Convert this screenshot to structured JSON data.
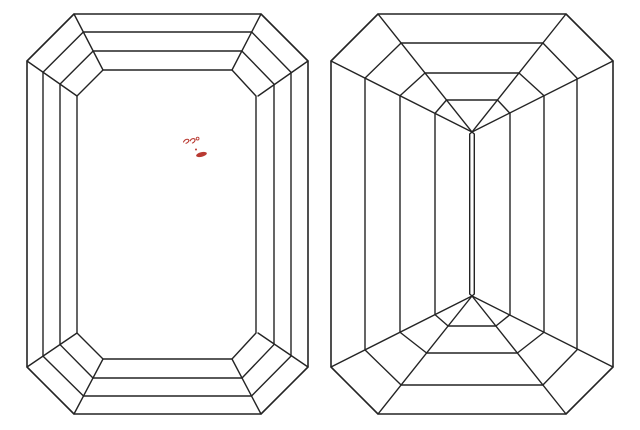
{
  "canvas": {
    "width": 640,
    "height": 430,
    "background": "#ffffff"
  },
  "style": {
    "line_color": "#242424",
    "line_width": 1.4,
    "girdle_line_width": 1.6,
    "annotation_color": "#b93a32"
  },
  "figures": {
    "crown": {
      "name": "emerald-cut-crown-top-view",
      "girdle": {
        "x1": 27,
        "y1": 14,
        "x2": 308,
        "y2": 414,
        "cut": 47
      },
      "table": {
        "x1": 77,
        "y1": 70,
        "x2": 256,
        "y2": 359,
        "cut": 26
      },
      "steps": [
        {
          "x1": 43,
          "y1": 32,
          "x2": 291,
          "y2": 396
        },
        {
          "x1": 60,
          "y1": 51,
          "x2": 274,
          "y2": 378
        }
      ]
    },
    "pavilion": {
      "name": "emerald-cut-pavilion-bottom-view",
      "girdle": {
        "x1": 331,
        "y1": 14,
        "x2": 613,
        "y2": 414,
        "cut": 47
      },
      "steps": [
        {
          "x1": 365,
          "y1": 43,
          "x2": 577,
          "y2": 385
        },
        {
          "x1": 400,
          "y1": 73,
          "x2": 544,
          "y2": 353
        },
        {
          "x1": 435,
          "y1": 100,
          "x2": 510,
          "y2": 326
        }
      ],
      "apex_top": {
        "x": 472,
        "y": 132
      },
      "apex_bottom": {
        "x": 472,
        "y": 296
      },
      "keel_half_gap": 2.3,
      "keel_inset": 2
    }
  },
  "annotation": {
    "name": "red-ink-scribble",
    "color": "#b93a32",
    "x": 183,
    "y": 136,
    "strokes": [
      "M0.5,6 C1.5,3.5 4.2,2.6 5.6,3.8 C6.4,4.9 4.8,6.9 3,7.3",
      "M7.2,4.8 C8,2.6 10.6,2 11.8,3.2 C12.6,4.6 11,6.6 9.4,7"
    ],
    "degree_circle": {
      "cx": 14.6,
      "cy": 2.6,
      "r": 1.4
    },
    "dot": {
      "cx": 13,
      "cy": 13.5,
      "r": 1
    },
    "ellipse": {
      "cx": 18.5,
      "cy": 18.5,
      "rx": 5.5,
      "ry": 2.3,
      "rotate": -14
    }
  }
}
